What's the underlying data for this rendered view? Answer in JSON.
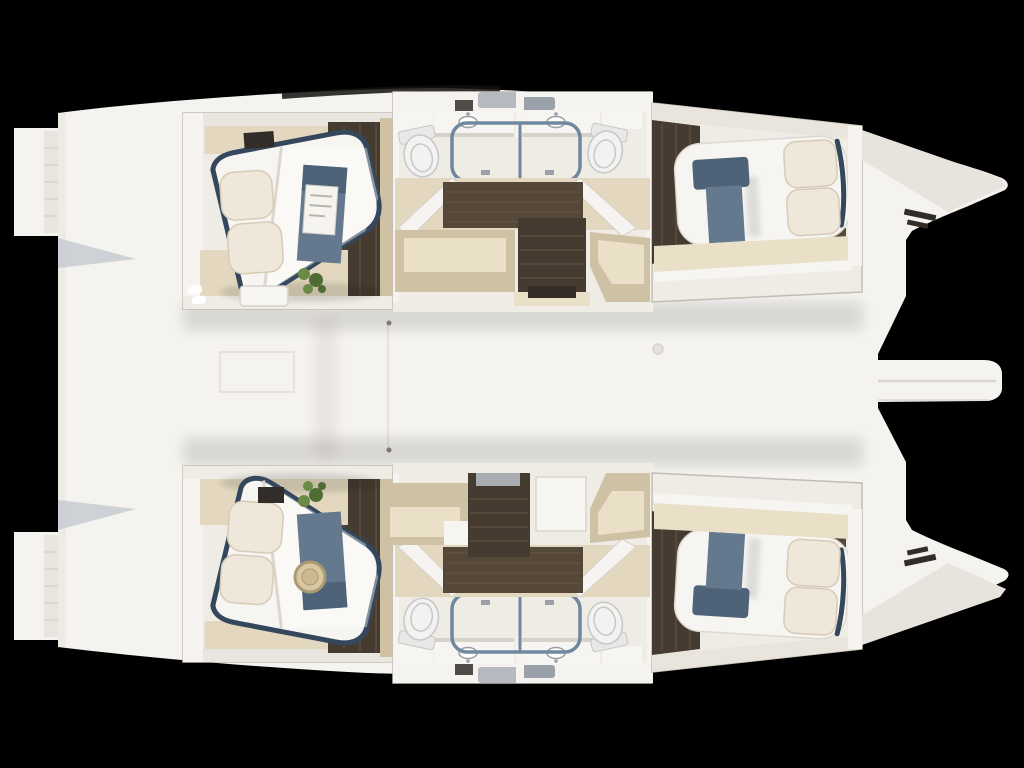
{
  "palette": {
    "bg": "#000000",
    "hull": "#f5f3ef",
    "hull_shade": "#e9e5df",
    "hull_shadow": "#d9d5ce",
    "toe_rail": "#12100d",
    "wall": "#efece6",
    "wall_bright": "#f6f4f0",
    "wall_shadow": "#d6d2ca",
    "floor_beige": "#e3d8bf",
    "cabinet_top": "#eadfc7",
    "cabinet_side": "#cfc1a4",
    "wood_dark": "#463b30",
    "wood_mid": "#554838",
    "wood_streak": "#6a5a47",
    "bed_white": "#f7f5f1",
    "bed_crease": "#dbd6ce",
    "pillow": "#efe8da",
    "pillow_shadow": "#d6cbb6",
    "frame_slate": "#34475c",
    "runner": "#64798e",
    "runner_dark": "#4e6378",
    "glass_blue": "#70889f",
    "shower_tray": "#eae8e3",
    "fixture_gray": "#9aa0a6",
    "toilet": "#f2f2f1",
    "toilet_shadow": "#c6c7c7",
    "hatch_gray": "#b6bac0",
    "hatch_dark": "#9ba1a8",
    "tv_dark": "#322d28",
    "plant": "#6b8a46",
    "plant_dark": "#4f6c33",
    "hat_tan": "#d8c7a0",
    "hat_ring": "#ab9a72",
    "magazine": "#f6f4ef",
    "step_pad": "#a9adb2",
    "counter_white": "#f6f5f2",
    "seam": "#e6e2db",
    "seam_dark": "#8d8880",
    "transom_shadow": "#c7cad0"
  },
  "boat": {
    "type": "catamaran",
    "view": "overhead-interior-cutaway-floorplan",
    "background": "black",
    "bow_direction": "right",
    "stern_features": [
      "upper-swim-platform",
      "lower-swim-platform"
    ],
    "bow_features": [
      "bowsprit",
      "upper-bow",
      "lower-bow",
      "anchor-locker-vents"
    ],
    "deck_features": [
      "skylight-hatches",
      "deck-seam-hatch",
      "deck-fitting",
      "deck-panel-line"
    ],
    "hulls": [
      {
        "id": "upper-hull",
        "cabins": [
          {
            "name": "aft-cabin",
            "furniture": [
              "island-double-bed",
              "two-pillows",
              "duvet",
              "blue-bed-runner",
              "magazine",
              "wall-mounted-tv",
              "bench",
              "potted-plant",
              "slippers",
              "wardrobe",
              "dark-wood-floor",
              "beige-carpet"
            ]
          },
          {
            "name": "aft-bathroom",
            "furniture": [
              "vanity-sink",
              "shower-cabin",
              "toilet"
            ]
          },
          {
            "name": "companionway",
            "furniture": [
              "stairs",
              "storage-cabinet"
            ]
          },
          {
            "name": "fwd-bathroom",
            "furniture": [
              "vanity-sink",
              "shower-cabin",
              "toilet"
            ]
          },
          {
            "name": "fwd-cabin",
            "furniture": [
              "double-bed",
              "two-pillows",
              "blue-bed-runner",
              "shelf-band",
              "dark-wood-floor"
            ]
          }
        ]
      },
      {
        "id": "lower-hull",
        "cabins": [
          {
            "name": "aft-cabin",
            "furniture": [
              "island-double-bed",
              "two-pillows",
              "duvet",
              "blue-bed-runner",
              "sun-hat",
              "wall-mounted-tv",
              "potted-plant",
              "wardrobe",
              "dark-wood-floor",
              "beige-carpet"
            ]
          },
          {
            "name": "aft-bathroom",
            "furniture": [
              "vanity-sink",
              "shower-cabin",
              "toilet"
            ]
          },
          {
            "name": "companionway",
            "furniture": [
              "stairs",
              "storage-cabinet",
              "white-counter"
            ]
          },
          {
            "name": "fwd-bathroom",
            "furniture": [
              "vanity-sink",
              "shower-cabin",
              "toilet"
            ]
          },
          {
            "name": "fwd-cabin",
            "furniture": [
              "double-bed",
              "two-pillows",
              "blue-bed-runner",
              "shelf-band",
              "dark-wood-floor"
            ]
          }
        ]
      }
    ]
  }
}
